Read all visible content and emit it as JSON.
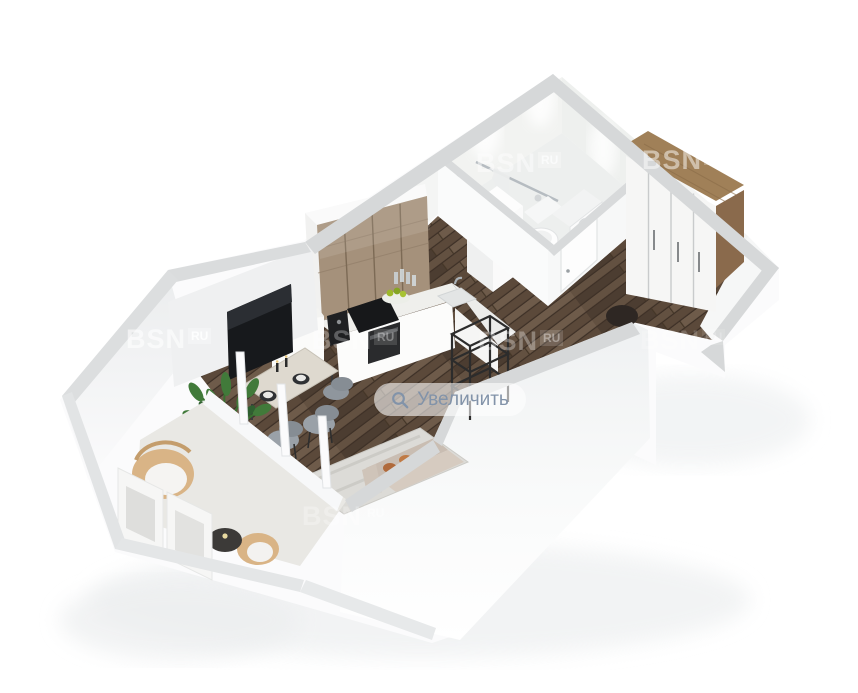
{
  "overlay": {
    "zoom_button": {
      "label": "Увеличить",
      "icon": "search-icon"
    },
    "watermark": {
      "brand": "BSN",
      "suffix": "RU"
    }
  },
  "palette": {
    "background": "#ffffff",
    "wall_top": "#d6d8da",
    "wall_face": "#f6f7f8",
    "floor_wood_dark": "#584739",
    "floor_wood_light": "#6f5c4c",
    "kitchen_cabinet_wood": "#a5917b",
    "wardrobe_wood": "#9c7c58",
    "bathroom_tile": "#f2f3f1",
    "rug": "#dcdbd7",
    "sofa": "#cfc3b8",
    "pillow_accent": "#b06a3b",
    "chair_gray": "#9aa1a8",
    "plant_green": "#417a3a",
    "rattan": "#d9b486",
    "metal_black": "#2c2c2c",
    "tv_black": "#17191c",
    "zoom_pill_text": "#8293a9",
    "zoom_pill_bg": "rgba(255,255,255,0.58)",
    "watermark_color": "rgba(255,255,255,0.62)"
  }
}
